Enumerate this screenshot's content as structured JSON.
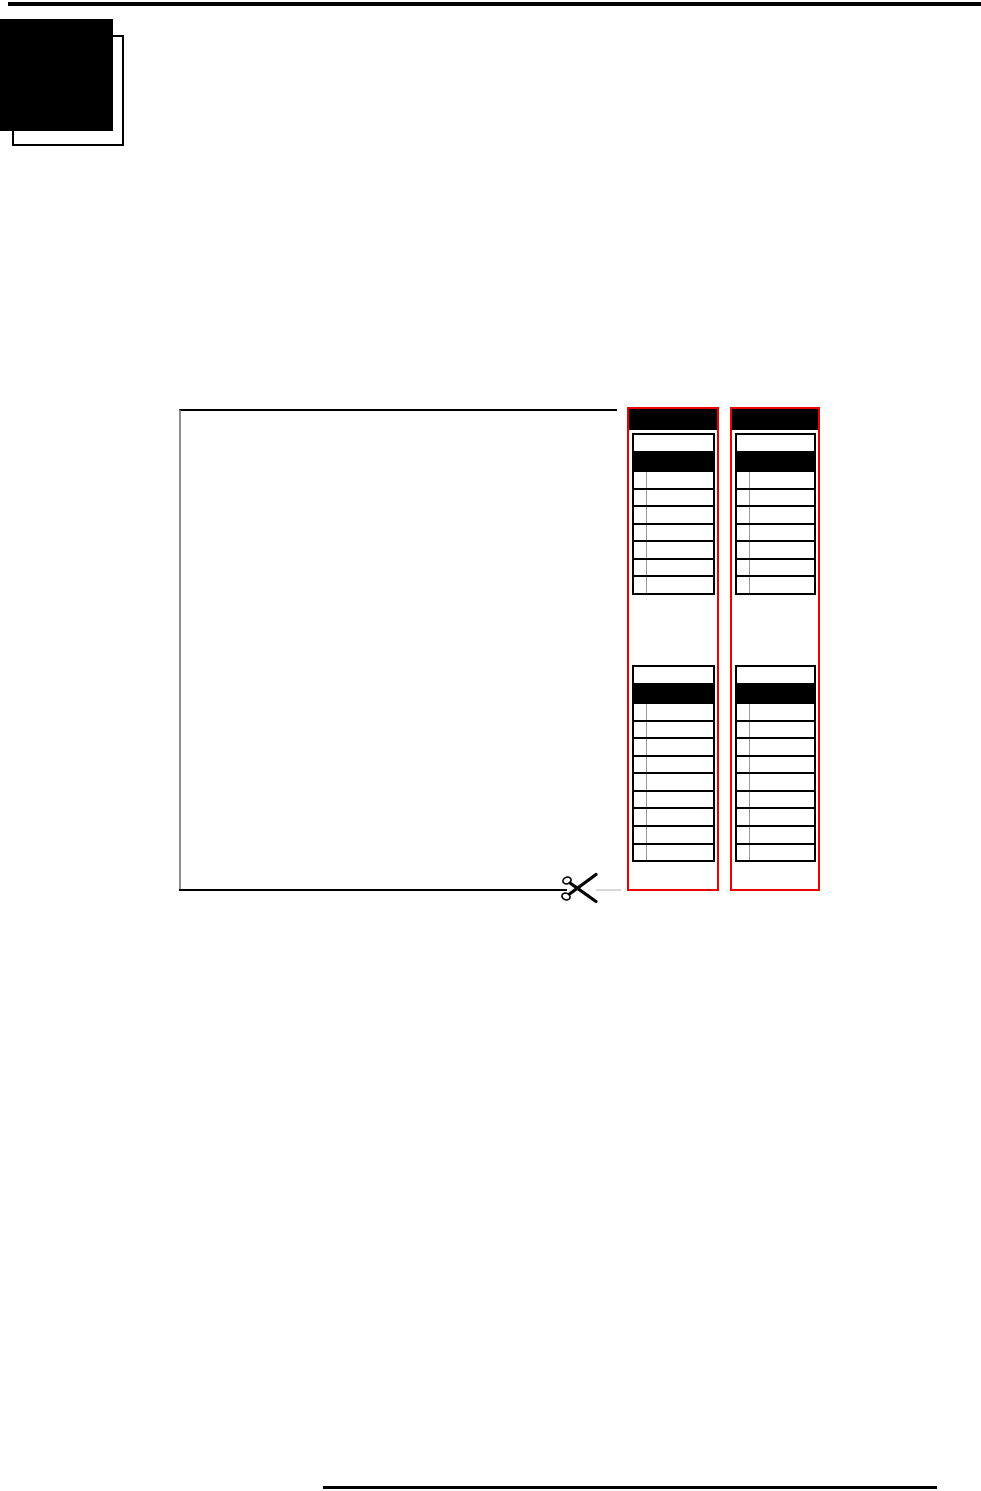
{
  "page": {
    "kind": "printed-manual-page-with-cutout-reference-cards",
    "background": "#ffffff"
  },
  "colors": {
    "card_border_red": "#ee0000",
    "rule_black": "#000000",
    "row_divider_gray": "#999999",
    "faint_cut_line_gray": "#d8d8d8",
    "cutout_box_left_border_gray": "#909090"
  },
  "chapter_tab": {
    "style": "solid-black-square-over-offset-outline-square"
  },
  "cut_out": {
    "icon": "scissors-icon",
    "box_is_empty": true
  },
  "cards": [
    {
      "name": "reference-card-1",
      "header_bar": "solid-black",
      "tables": [
        {
          "title_row": "blank",
          "header_row": "solid-black",
          "data_rows": 7
        },
        {
          "title_row": "blank",
          "header_row": "solid-black",
          "data_rows": 9
        }
      ]
    },
    {
      "name": "reference-card-2",
      "header_bar": "solid-black",
      "tables": [
        {
          "title_row": "blank",
          "header_row": "solid-black",
          "data_rows": 7
        },
        {
          "title_row": "blank",
          "header_row": "solid-black",
          "data_rows": 9
        }
      ]
    }
  ],
  "rules": {
    "top_rule": "thin-black-full-width",
    "bottom_rule": "thick-black-partial-width"
  }
}
